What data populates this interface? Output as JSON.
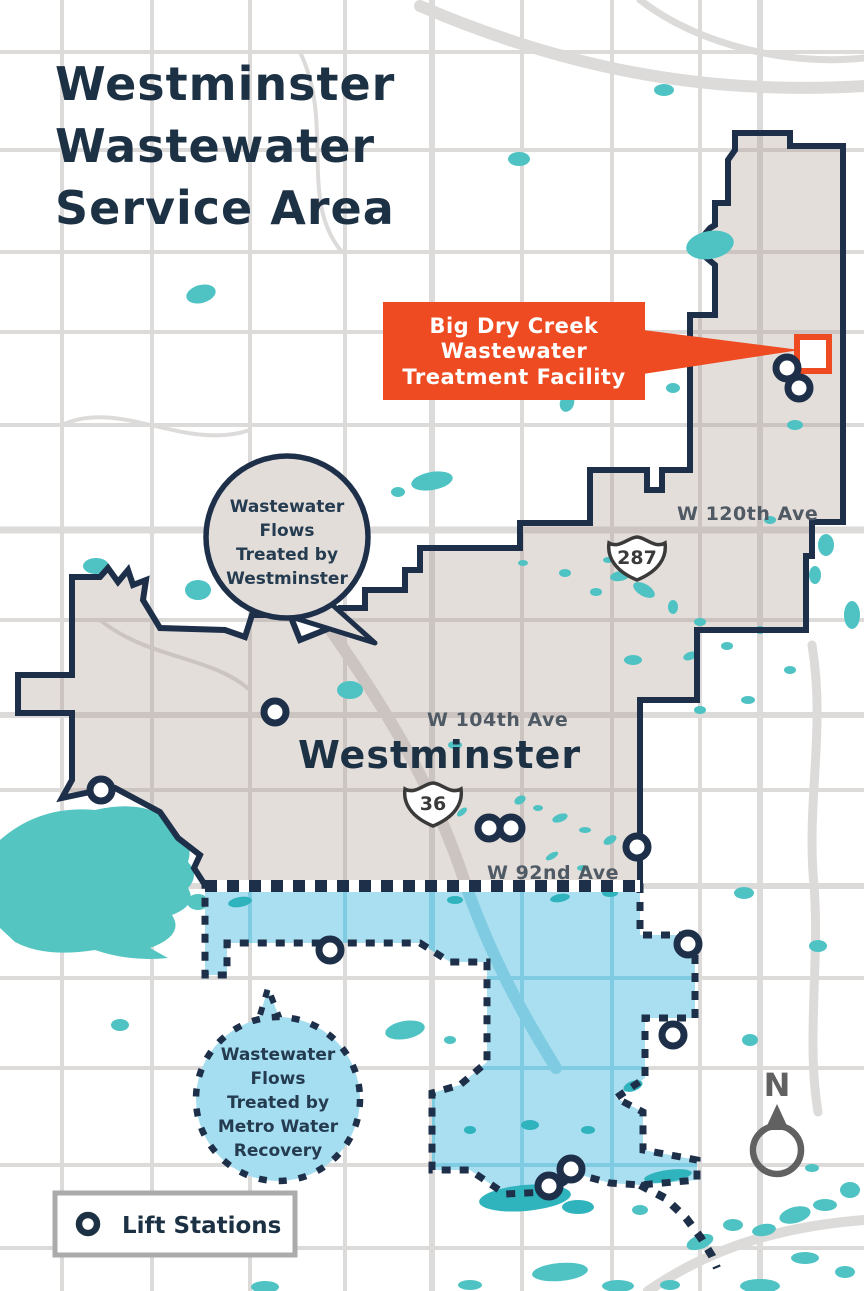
{
  "page": {
    "title_line1": "Westminster",
    "title_line2": "Wastewater",
    "title_line3": "Service Area"
  },
  "facility_callout": {
    "line1": "Big Dry Creek",
    "line2": "Wastewater",
    "line3": "Treatment Facility"
  },
  "westminster_bubble": {
    "line1": "Wastewater",
    "line2": "Flows",
    "line3": "Treated by",
    "line4": "Westminster"
  },
  "metro_bubble": {
    "line1": "Wastewater",
    "line2": "Flows",
    "line3": "Treated by",
    "line4": "Metro Water",
    "line5": "Recovery"
  },
  "road_labels": {
    "w120": "W 120th Ave",
    "w104": "W 104th Ave",
    "w92": "W 92nd Ave"
  },
  "city_label": "Westminster",
  "shields": {
    "us287": "287",
    "us36": "36"
  },
  "legend": {
    "lift_stations_label": "Lift Stations"
  },
  "compass": {
    "north_label": "N"
  },
  "colors": {
    "navy": "#1E3049",
    "orange": "#EE4B22",
    "teal": "#4FC3C3",
    "service_area_gray": "#E4DEDB",
    "metro_blue": "#A9DFF0"
  }
}
